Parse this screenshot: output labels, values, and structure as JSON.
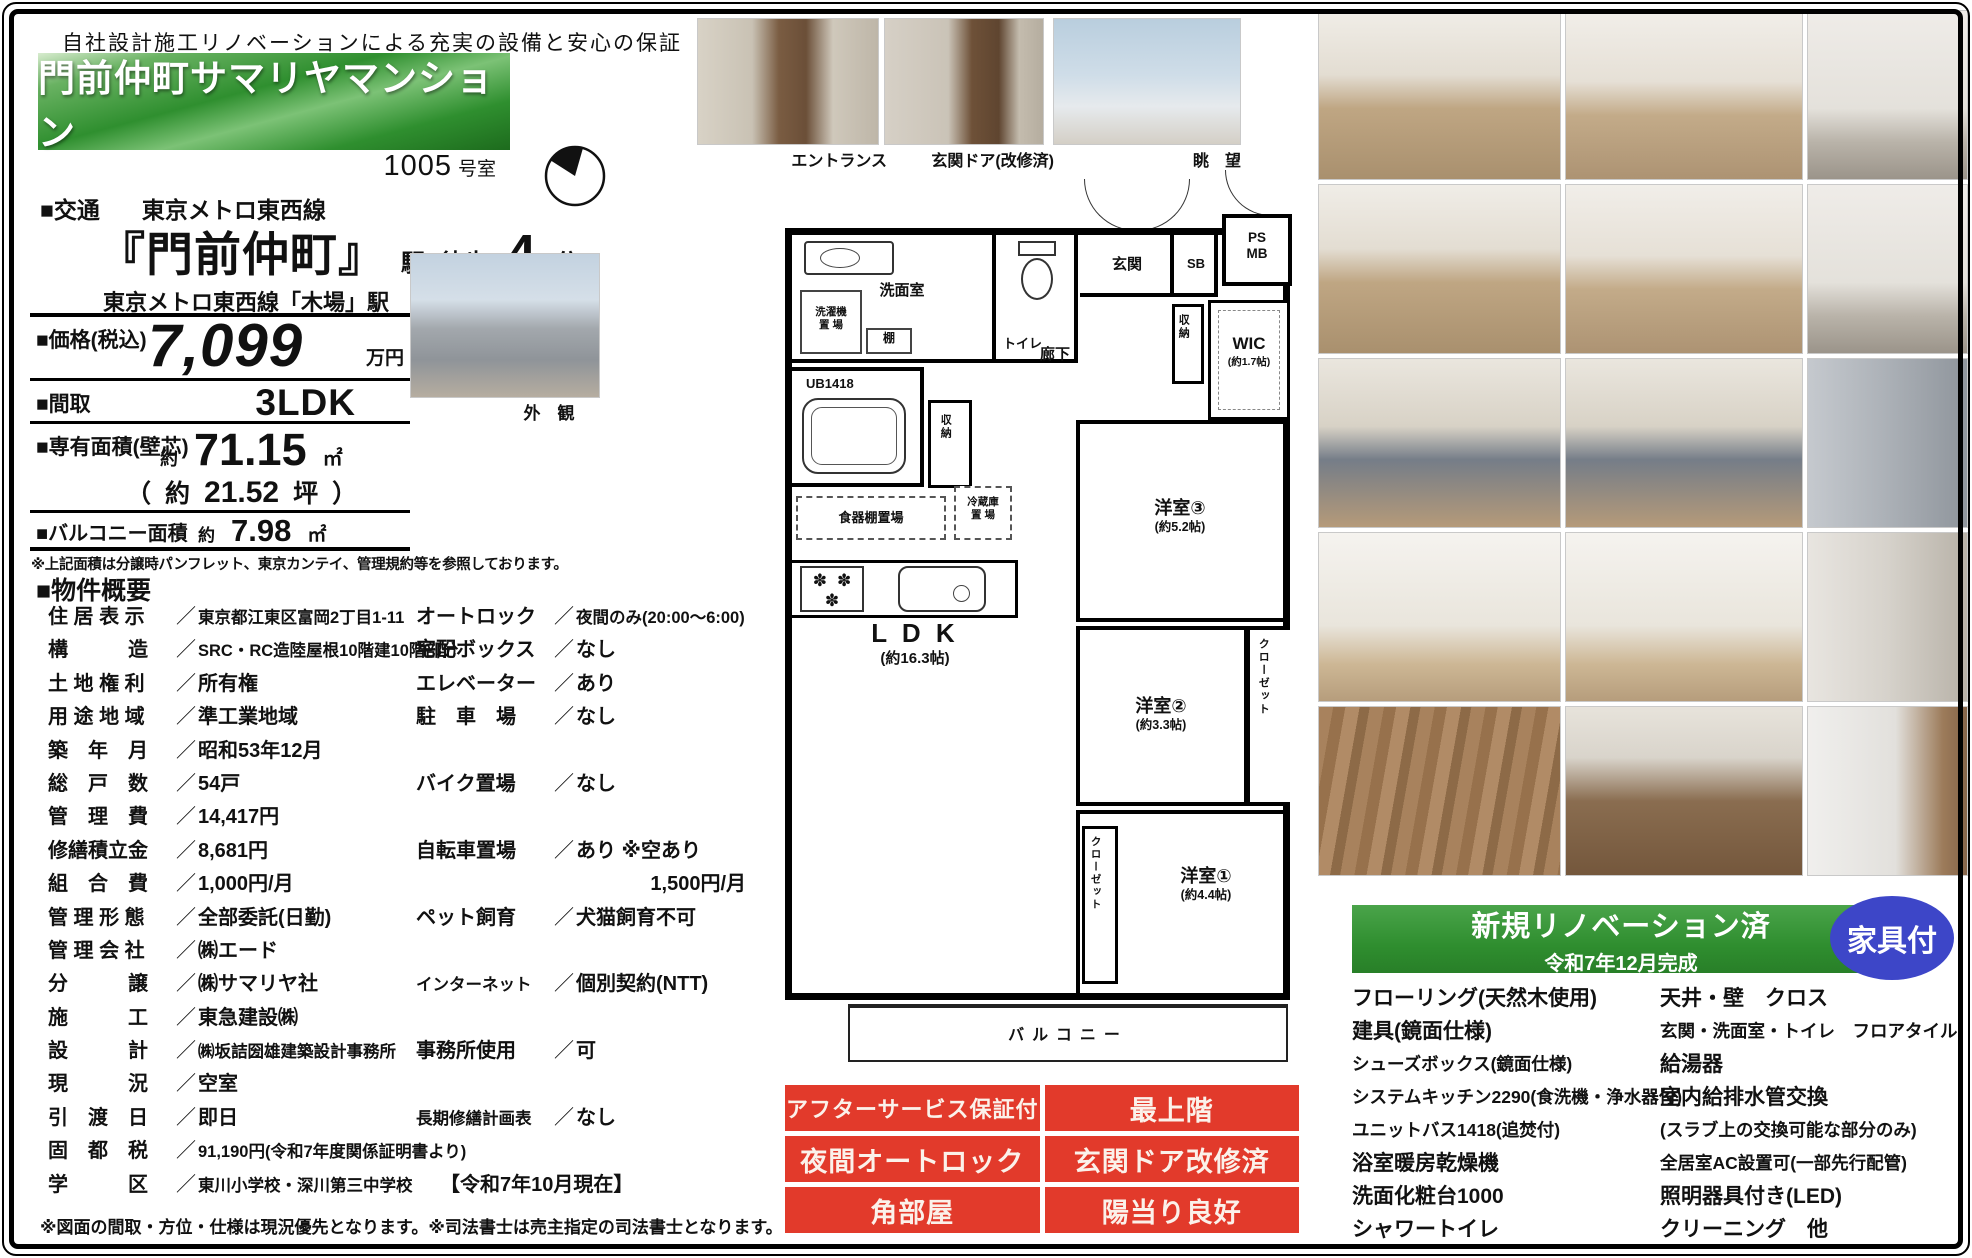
{
  "header": {
    "tagline": "自社設計施工リノベーションによる充実の設備と安心の保証",
    "property_name": "門前仲町サマリヤマンション",
    "room_number": "1005",
    "room_unit": "号室"
  },
  "access": {
    "label": "■交通",
    "line_name": "東京メトロ東西線",
    "station": "『門前仲町』",
    "station_suffix": "駅",
    "walk_prefix": "徒歩",
    "walk_minutes": "4",
    "walk_suffix": "分",
    "secondary": "東京メトロ東西線「木場」駅　徒歩6分"
  },
  "spec": {
    "price_label": "■価格(税込)",
    "price_value": "7,099",
    "price_unit": "万円",
    "plan_label": "■間取",
    "plan_value": "3LDK",
    "area_label": "■専有面積(壁芯)",
    "approx": "約",
    "area_value": "71.15",
    "area_unit": "㎡",
    "tsubo_open": "（",
    "tsubo_approx": "約",
    "tsubo_value": "21.52",
    "tsubo_unit": "坪",
    "tsubo_close": "）",
    "balcony_label": "■バルコニー面積",
    "balcony_value": "7.98",
    "balcony_unit": "㎡",
    "note": "※上記面積は分譲時パンフレット、東京カンテイ、管理規約等を参照しております。"
  },
  "overview": {
    "title": "■物件概要",
    "separator": "／",
    "rows": [
      {
        "l": "住 居 表 示",
        "lv": "東京都江東区富岡2丁目1-11",
        "r": "オートロック",
        "rv": "夜間のみ(20:00～6:00)"
      },
      {
        "l": "構　　　造",
        "lv": "SRC・RC造陸屋根10階建10階部分",
        "r": "宅配ボックス",
        "rv": "なし"
      },
      {
        "l": "土 地 権 利",
        "lv": "所有権",
        "r": "エレベーター",
        "rv": "あり"
      },
      {
        "l": "用 途 地 域",
        "lv": "準工業地域",
        "r": "駐　車　場",
        "rv": "なし"
      },
      {
        "l": "築　年　月",
        "lv": "昭和53年12月",
        "r": "",
        "rv": ""
      },
      {
        "l": "総　戸　数",
        "lv": "54戸",
        "r": "バイク置場",
        "rv": "なし"
      },
      {
        "l": "管　理　費",
        "lv": "14,417円",
        "r": "",
        "rv": ""
      },
      {
        "l": "修繕積立金",
        "lv": "8,681円",
        "r": "自転車置場",
        "rv": "あり ※空あり"
      },
      {
        "l": "組　合　費",
        "lv": "1,000円/月",
        "r": "",
        "rv": "1,500円/月",
        "plain": true,
        "pos": "right"
      },
      {
        "l": "管 理 形 態",
        "lv": "全部委託(日勤)",
        "r": "ペット飼育",
        "rv": "犬猫飼育不可"
      },
      {
        "l": "管 理 会 社",
        "lv": "㈱エード",
        "r": "",
        "rv": ""
      },
      {
        "l": "分　　　譲",
        "lv": "㈱サマリヤ社",
        "r": "インターネット",
        "rv": "個別契約(NTT)"
      },
      {
        "l": "施　　　工",
        "lv": "東急建設㈱",
        "r": "",
        "rv": ""
      },
      {
        "l": "設　　　計",
        "lv": "㈱坂詰圀雄建築設計事務所",
        "r": "事務所使用",
        "rv": "可"
      },
      {
        "l": "現　　　況",
        "lv": "空室",
        "r": "",
        "rv": ""
      },
      {
        "l": "引　渡　日",
        "lv": "即日",
        "r": "長期修繕計画表",
        "rv": "なし"
      },
      {
        "l": "固　都　税",
        "lv": "91,190円(令和7年度関係証明書より)",
        "r": "",
        "rv": ""
      },
      {
        "l": "学　　　区",
        "lv": "東川小学校・深川第三中学校",
        "r": "",
        "rv": "【令和7年10月現在】",
        "plain": true,
        "pos": "mid"
      }
    ],
    "footnote": "※図面の間取・方位・仕様は現況優先となります。※司法書士は売主指定の司法書士となります。"
  },
  "photos": {
    "captions": {
      "entrance": "エントランス",
      "door": "玄関ドア(改修済)",
      "view": "眺　望",
      "exterior": "外　観"
    },
    "grid": [
      "living",
      "dining",
      "hallway",
      "living",
      "dining",
      "hallway",
      "kitchen",
      "kitchen",
      "graydoor",
      "bedroom",
      "bedroom",
      "closet",
      "woodfloor",
      "vanity",
      "washbasin"
    ]
  },
  "floorplan": {
    "senmen": "洗面室",
    "sentaku": "洗濯機\n置 場",
    "tana": "棚",
    "toilet": "トイレ",
    "genkan": "玄関",
    "sb": "SB",
    "psmb": "PS\nMB",
    "rouka": "廊下",
    "shuno": "収納",
    "wic": "WIC",
    "wic_size": "(約1.7帖)",
    "ub": "UB1418",
    "shokki": "食器棚置場",
    "reizo": "冷蔵庫\n置 場",
    "ldk": "L D K",
    "ldk_size": "(約16.3帖)",
    "y3": "洋室③",
    "y3_size": "(約5.2帖)",
    "y2": "洋室②",
    "y2_size": "(約3.3帖)",
    "y1": "洋室①",
    "y1_size": "(約4.4帖)",
    "closet": "クローゼット",
    "balcony": "バルコニー"
  },
  "badges": [
    "アフターサービス保証付",
    "最上階",
    "夜間オートロック",
    "玄関ドア改修済",
    "角部屋",
    "陽当り良好"
  ],
  "renovation": {
    "title": "新規リノベーション済",
    "date": "令和7年12月完成",
    "badge": "家具付"
  },
  "features": {
    "left": [
      "フローリング(天然木使用)",
      "建具(鏡面仕様)",
      "シューズボックス(鏡面仕様)",
      "システムキッチン2290(食洗機・浄水器付)",
      "ユニットバス1418(追焚付)",
      "浴室暖房乾燥機",
      "洗面化粧台1000",
      "シャワートイレ"
    ],
    "right": [
      "天井・壁　クロス",
      "玄関・洗面室・トイレ　フロアタイル",
      "給湯器",
      "室内給排水管交換",
      "(スラブ上の交換可能な部分のみ)",
      "全居室AC設置可(一部先行配管)",
      "照明器具付き(LED)",
      "クリーニング　他"
    ]
  },
  "colors": {
    "badge_red": "#e23a2b",
    "badge_blue": "#3d46c8",
    "banner_green": "#2f8f2f"
  }
}
